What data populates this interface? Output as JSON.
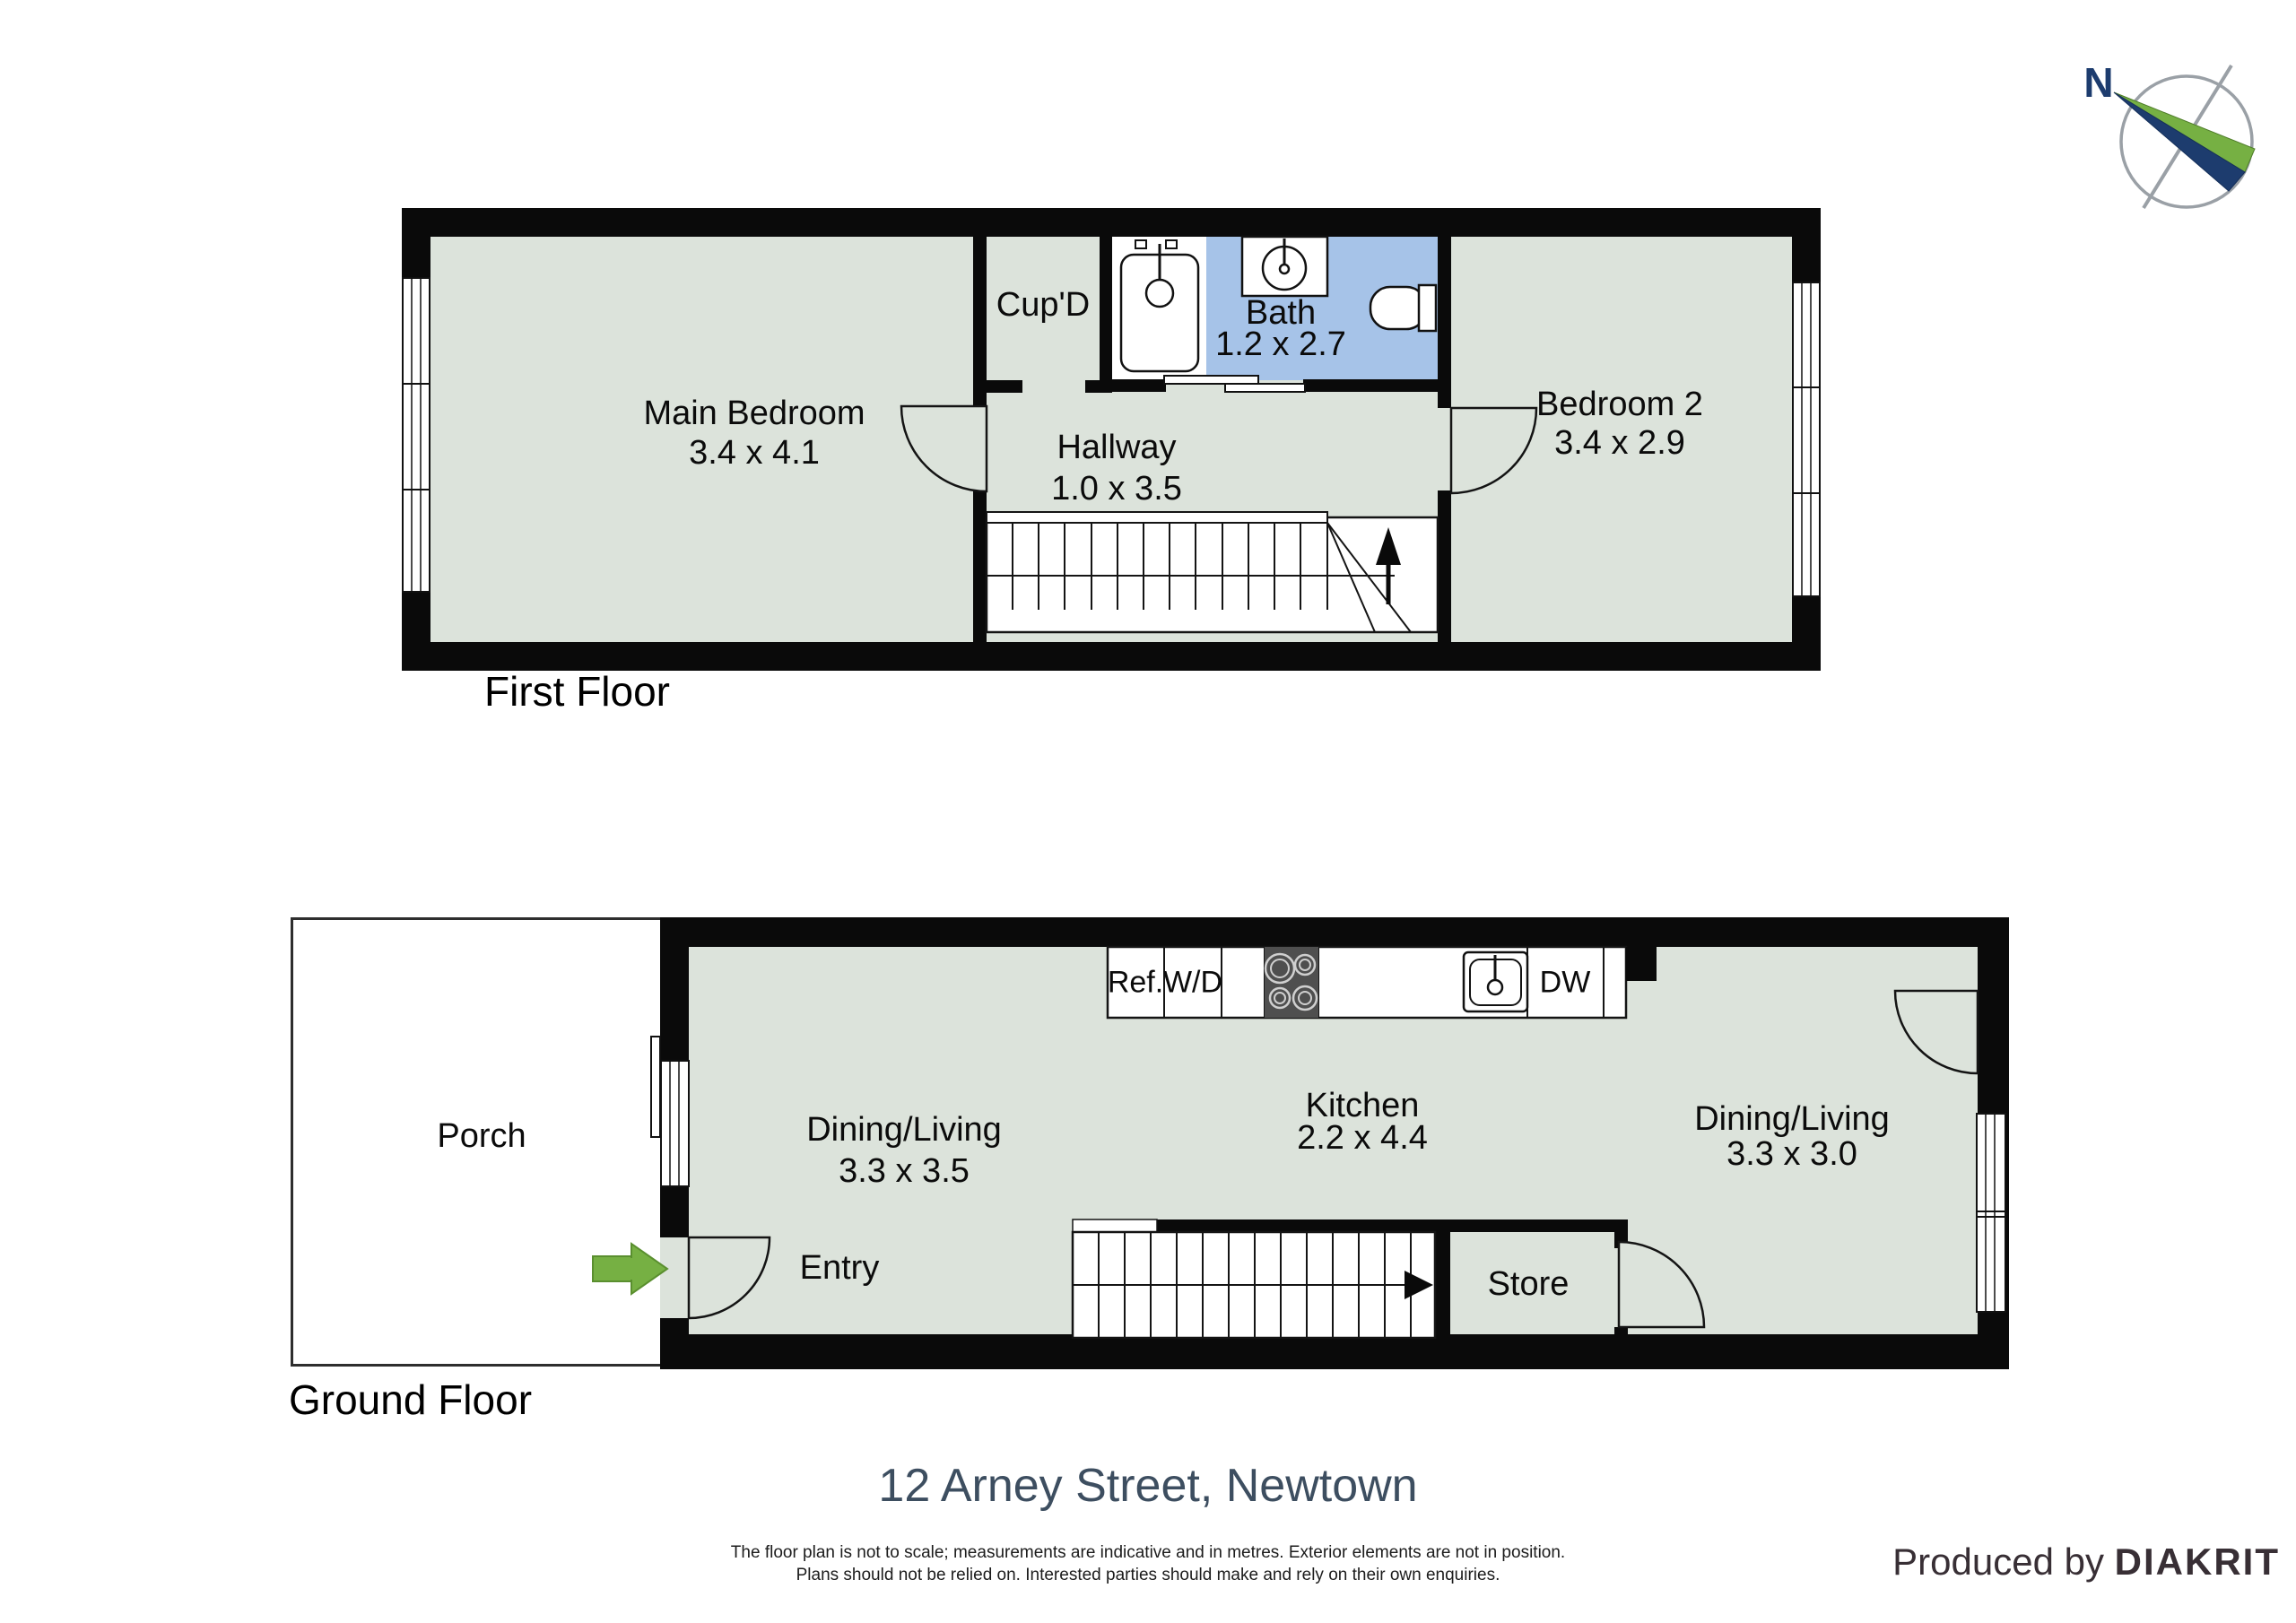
{
  "compass": {
    "north_label": "N"
  },
  "first_floor": {
    "label": "First Floor",
    "rooms": {
      "main_bedroom": {
        "name": "Main Bedroom",
        "dims": "3.4 x 4.1"
      },
      "cupd": {
        "name": "Cup'D"
      },
      "bath": {
        "name": "Bath",
        "dims": "1.2 x 2.7"
      },
      "hallway": {
        "name": "Hallway",
        "dims": "1.0 x 3.5"
      },
      "bedroom2": {
        "name": "Bedroom 2",
        "dims": "3.4 x 2.9"
      }
    }
  },
  "ground_floor": {
    "label": "Ground Floor",
    "rooms": {
      "porch": {
        "name": "Porch"
      },
      "dining_living_left": {
        "name": "Dining/Living",
        "dims": "3.3 x 3.5"
      },
      "entry": {
        "name": "Entry"
      },
      "kitchen": {
        "name": "Kitchen",
        "dims": "2.2 x 4.4"
      },
      "dining_living_right": {
        "name": "Dining/Living",
        "dims": "3.3 x 3.0"
      },
      "store": {
        "name": "Store"
      }
    },
    "appliances": {
      "fridge": "Ref.",
      "washer_dryer": "W/D",
      "dishwasher": "DW"
    }
  },
  "footer": {
    "address": "12 Arney Street, Newtown",
    "disclaimer_line1": "The floor plan is not to scale; measurements are indicative and in metres. Exterior elements are not in position.",
    "disclaimer_line2": "Plans should not be relied on. Interested parties should make and rely on their own enquiries.",
    "produced_by": "Produced by",
    "producer": "DIAKRIT"
  },
  "colors": {
    "floor": "#dce3db",
    "bath": "#a6c3e8",
    "green": "#76b043",
    "navy": "#1d3c6e",
    "title": "#3d4e60",
    "producer": "#382f35"
  }
}
